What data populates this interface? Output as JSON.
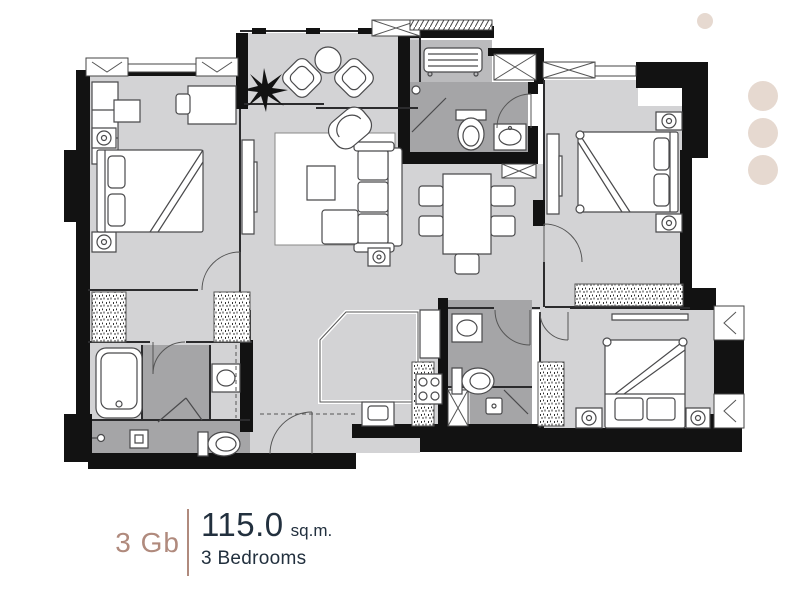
{
  "label": {
    "unit_type": "3 Gb",
    "area_value": "115.0",
    "area_unit": "sq.m.",
    "bedrooms": "3 Bedrooms"
  },
  "colors": {
    "accent_tan": "#b08a7d",
    "text_navy": "#22303e",
    "floor": "#d3d3d5",
    "floor_dark": "#a5a5a7",
    "floor_medium": "#bbbbbd",
    "wall": "#121212",
    "furniture_line": "#4a4a4c",
    "deco_circle": "#e6d9d0",
    "rug": "#ffffff"
  }
}
